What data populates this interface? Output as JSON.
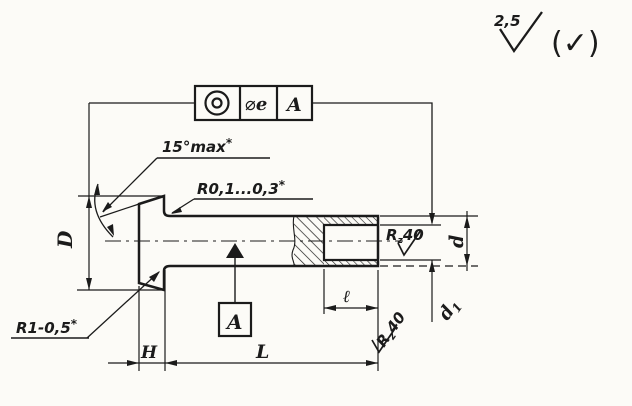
{
  "colors": {
    "ink": "#1b1b1b",
    "paper": "#fcfbf7"
  },
  "finish_marks": {
    "general_value": "2,5",
    "alternate_mark": "(✓)",
    "hole_roughness": {
      "prefix": "R",
      "sub": "z",
      "value": "40"
    },
    "end_face_roughness": {
      "prefix": "R",
      "sub": "z",
      "value": "40"
    }
  },
  "tolerance_frame": {
    "symbol": "concentricity",
    "value_dia": "⌀",
    "value_letter": "e",
    "datum_ref": "A"
  },
  "notes": {
    "cone_angle": {
      "text": "15°max",
      "star": "*"
    },
    "fillet_radius": {
      "text": "R0,1...0,3",
      "star": "*"
    },
    "head_fillet": {
      "text": "R1-0,5",
      "star": "*"
    }
  },
  "datum_flag": {
    "label": "A"
  },
  "dimensions": {
    "head_diameter": "D",
    "head_height": "H",
    "total_length": "L",
    "hole_depth": "ℓ",
    "shank_diameter": "d",
    "hole_diameter_letter": "d",
    "hole_diameter_sub": "1"
  }
}
